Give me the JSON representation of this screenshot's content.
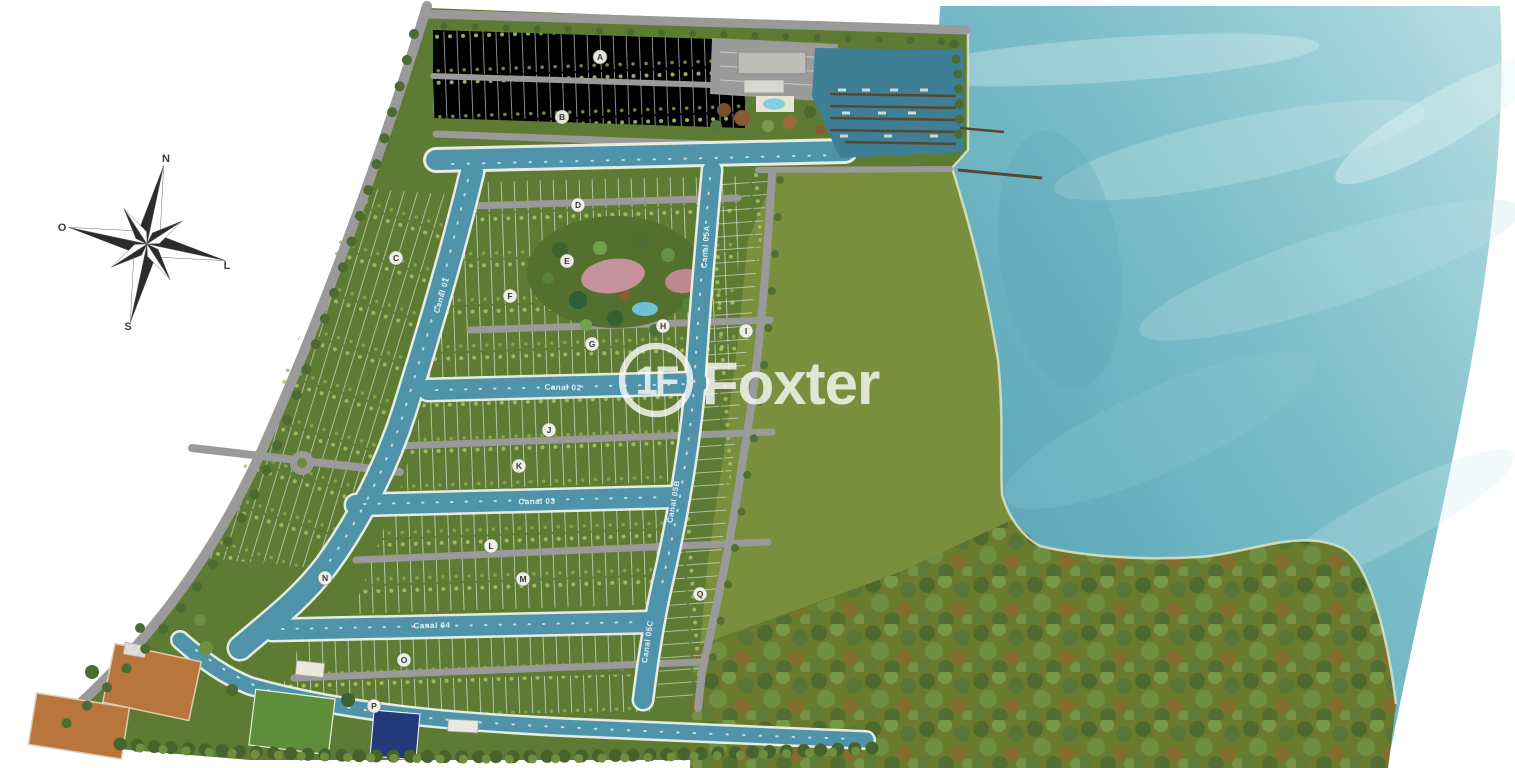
{
  "watermark": {
    "brand": "Foxter",
    "monogram": "1F"
  },
  "compass": {
    "north": "N",
    "south": "S",
    "east": "L",
    "west": "O"
  },
  "canal_labels": {
    "c01": "Canal 01",
    "c02": "Canal 02",
    "c03": "Canal 03",
    "c04": "Canal 04",
    "c05a": "Canal 05A",
    "c05b": "Canal 05B",
    "c05c": "Canal 05C"
  },
  "block_markers": [
    "A",
    "B",
    "C",
    "D",
    "E",
    "F",
    "G",
    "H",
    "I",
    "J",
    "K",
    "L",
    "M",
    "N",
    "O",
    "P",
    "Q"
  ],
  "colors": {
    "page_background": "#ffffff",
    "bay_water": "#6fb3c1",
    "canal_water": "#4f93aa",
    "marina_basin": "#3e7f95",
    "grass": "#5e7b33",
    "meadow": "#7a8f3e",
    "forest": "#6b7b2d",
    "road": "#9a9a9a",
    "court_clay": "#b9763c",
    "pool_navy": "#233a7a",
    "watermark_white": "#ffffff"
  }
}
